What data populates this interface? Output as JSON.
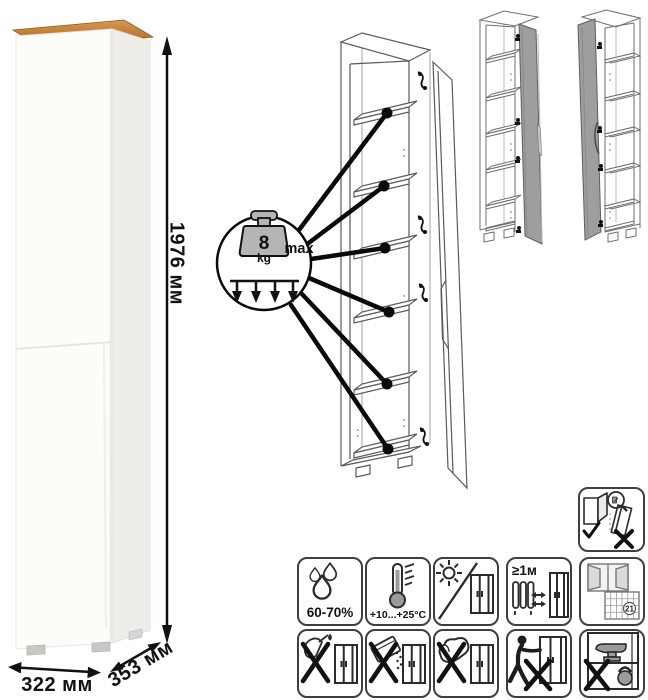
{
  "product": {
    "name": "tall-one-door-cabinet",
    "dimensions": {
      "height_label": "1976 мм",
      "width_label": "322 мм",
      "depth_label": "353 мм"
    },
    "colors": {
      "wood_top": "#bf7d36",
      "body_white": "#fcfcf9",
      "side_shade": "#eeede9",
      "drawing_line": "#5a5a5a",
      "door_gray": "#9e9e9e",
      "outline": "#2b2b2b"
    }
  },
  "callout": {
    "weight_value": "8",
    "weight_unit": "kg",
    "max_label": "max",
    "shelves_pointed": 6
  },
  "care": {
    "humidity_label": "60-70%",
    "temperature_label": "+10...+25°C",
    "heat_distance_label": "≥1м",
    "calendar_day": "21",
    "row1_icons": [
      "humidity-icon",
      "temperature-icon",
      "no-direct-sunlight-icon",
      "heat-distance-icon",
      "ventilation-calendar-icon"
    ],
    "row2_icons": [
      "no-sharp-tools-icon",
      "no-abrasive-powder-icon",
      "no-abrasive-sponge-icon",
      "no-dragging-icon",
      "no-overload-icon"
    ],
    "safety_icon": "anti-tip-wall-mount-icon"
  }
}
